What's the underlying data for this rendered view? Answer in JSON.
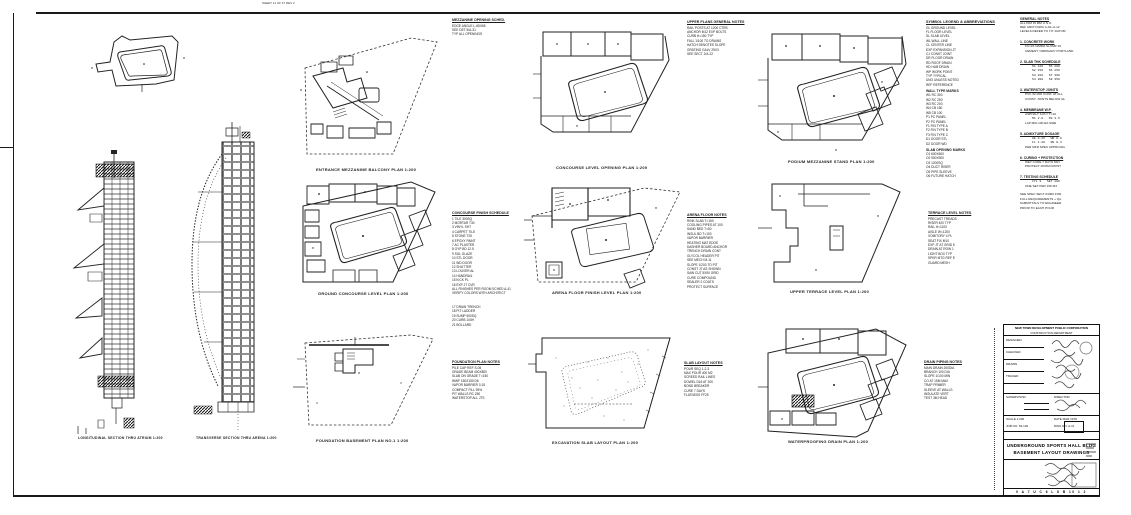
{
  "sheet": {
    "top_annotation": "SHEET 11 OF 47  REV 2",
    "ink": "#1a1a1a",
    "paper": "#ffffff"
  },
  "elevations": {
    "cap1": "LONGITUDINAL SECTION THRU ATRIUM 1:200",
    "cap2": "TRANSVERSE SECTION THRU ARENA 1:200"
  },
  "plans": {
    "r1c1": {
      "caption": "ENTRANCE MEZZANINE BALCONY PLAN 1:200"
    },
    "r1c2": {
      "caption": "CONCOURSE LEVEL OPENING PLAN 1:200"
    },
    "r1c3": {
      "caption": "PODIUM MEZZANINE STAND PLAN 1:200"
    },
    "r2c1": {
      "caption": "GROUND CONCOURSE LEVEL PLAN 1:200"
    },
    "r2c2": {
      "caption": "ARENA FLOOR FINISH LEVEL PLAN 1:200"
    },
    "r2c3": {
      "caption": "UPPER TERRACE LEVEL PLAN 1:200"
    },
    "r3c1": {
      "caption": "FOUNDATION BASEMENT PLAN NO.1 1:200"
    },
    "r3c2": {
      "caption": "EXCAVATION SLAB LAYOUT PLAN 1:200"
    },
    "r3c3": {
      "caption": "WATERPROOFING DRAIN PLAN 1:200"
    }
  },
  "notes": {
    "A": {
      "title": "MEZZANINE OPENING SCHED.",
      "lines": [
        "EDGE ANGLE L-65X65",
        "SEE DET 5/A-31",
        "TYP ALL OPENINGS"
      ]
    },
    "B": {
      "title": "UPPER PLANS GENERAL NOTES",
      "lines": [
        "RAIL POSTS AT 1200 CTRS",
        "ANCHOR M12 EXP BOLTS",
        "CURB H=150 TYP",
        "FALL 1/100 TO DRAINS",
        "HATCH DENOTES SLOPE",
        "GRATING GALV 25X3",
        "SEE SECT 2/A-22"
      ]
    },
    "C": {
      "title": "CONCOURSE FINISH SCHEDULE",
      "lines": [
        "1 TILE 300SQ",
        "2 MORTAR T30",
        "3 VINYL SHT",
        "4 CARPET TILE",
        "5 STONE T25",
        "6 EPOXY PAINT",
        "7 AC PLASTER",
        "8 GYP BD 12.5",
        "9 SGL GLAZE",
        "10 STL DOOR",
        "11 WD DOOR",
        "12 SHUTTER",
        "13 LOUVER AL",
        "14 HANDRAIL",
        "15 KICK PL",
        "16 EXP JT CVR",
        "ALL FINISHES PER ROOM SCHED A-41",
        "VERIFY COLORS WITH ARCHITECT"
      ]
    },
    "C2": {
      "lines": [
        "17 DRAIN TRENCH",
        "18 PIT LADDER",
        "19 SUMP 600SQ",
        "20 CURB 100H",
        "21 BOLLARD"
      ]
    },
    "D": {
      "title": "ARENA FLOOR NOTES",
      "lines": [
        "RINK SLAB T=150",
        "COOLING PIPES AT 100",
        "SAND BED T=50",
        "INSUL BD T=100",
        "VAPOR BARRIER",
        "HEATING MAT EDGE",
        "DASHER BOARD ANCHOR",
        "TRENCH DRAIN CONT",
        "GLYCOL HEADER PIT",
        "SEE MECH M-11",
        "SLOPE 1/200 TO PIT",
        "CONST JT AS SHOWN",
        "SAW CUT 5X50 GRID",
        "CURE COMPOUND",
        "SEALER 2 COATS",
        "PROTECT SURFACE"
      ]
    },
    "E": {
      "title": "TERRACE LEVEL NOTES",
      "lines": [
        "PRECAST TREADS",
        "RISER 400 TYP",
        "RAIL H=1100",
        "AISLE W=1200",
        "VOMITORY 4 PL",
        "SEAT FIX M10",
        "EXP JT AT GRID 5",
        "DRAIN AT ROW 1",
        "LIGHT BOX TYP",
        "SPKR MTG REF E",
        "GUARD MESH"
      ]
    },
    "F": {
      "title": "FOUNDATION PLAN NOTES",
      "lines": [
        "PILE CAP REF S-05",
        "GRADE BEAM 400X800",
        "SLAB ON GRADE T=150",
        "WWF 150X150 D6",
        "VAPOR BARRIER 0.15",
        "COMPACT FILL 95%",
        "PIT WALLS RC 250",
        "WATERSTOP ALL JTS"
      ]
    },
    "G": {
      "title": "SLAB LAYOUT NOTES",
      "lines": [
        "POUR SEQ 1-2-3",
        "MAX POUR 400 M2",
        "SCREED RAIL LINES",
        "DOWEL D16 AT 300",
        "BOND BREAKER",
        "CURE 7 DAYS",
        "FLATNESS FF25"
      ]
    },
    "H": {
      "title": "DRAIN PIPING NOTES",
      "lines": [
        "MAIN DRAIN 200DIA",
        "BRANCH 100 DIA",
        "SLOPE 1/100 MIN",
        "CO AT 15M MAX",
        "TRAP PRIMER",
        "SLEEVE AT WALLS",
        "INSULATE VERT",
        "TEST 3M HEAD"
      ]
    }
  },
  "legend": {
    "title": "SYMBOL LEGEND & ABBREVIATIONS",
    "lines1": [
      "GL GROUND LEVEL",
      "FL FLOOR LEVEL",
      "SL SLAB LEVEL",
      "WL WALL LINE",
      "CL CENTER LINE",
      "EXP EXPANSION JT",
      "CJ CONST JOINT",
      "DR FLOOR DRAIN",
      "RD ROOF DRAIN",
      "HD HUB DRAIN",
      "WP WORK POINT",
      "TYP TYPICAL",
      "UNO UNLESS NOTED",
      "REF REFERENCE"
    ],
    "sub1": "WALL TYPE MARKS",
    "lines2": [
      "W1 RC 300",
      "W2 RC 250",
      "W3 RC 200",
      "W4 CB 150",
      "W5 CB 100",
      "P1 PC PANEL",
      "P2 PC PANEL",
      "F1 FIN TYPE A",
      "F2 FIN TYPE B",
      "F3 FIN TYPE C",
      "D1 DOOR STL",
      "D2 DOOR WD"
    ],
    "sub2": "SLAB OPENING MARKS",
    "lines3": [
      "O1 600X600",
      "O2 900X900",
      "O3 1200SQ",
      "O4 DUCT RISER",
      "O5 PIPE SLEEVE",
      "O6 FUTURE HATCH"
    ]
  },
  "rightcol": {
    "blocks": [
      {
        "k": "h",
        "t": "GENERAL NOTES"
      },
      {
        "k": "l",
        "t": "ALL DIM IN MM U.N.O."
      },
      {
        "k": "l",
        "t": "REF ARCH DWG A-01~A-12"
      },
      {
        "k": "l",
        "t": "LEVELS REFER TO T.P. DATUM"
      },
      {
        "k": "g",
        "t": ""
      },
      {
        "k": "h",
        "t": "1. CONCRETE WORK"
      },
      {
        "k": "i",
        "t": "FC=24 N/MM2 SLUMP 15"
      },
      {
        "k": "i",
        "t": "CEMENT: ORDINARY PORTLAND"
      },
      {
        "k": "g",
        "t": ""
      },
      {
        "k": "h",
        "t": "2. SLAB THK SCHEDULE"
      },
      {
        "k": "t",
        "t": "S1 120   S5 200"
      },
      {
        "k": "t",
        "t": "S2 150   S6 250"
      },
      {
        "k": "t",
        "t": "S3 180   S7 300"
      },
      {
        "k": "t",
        "t": "S4 200   S8 350"
      },
      {
        "k": "g",
        "t": ""
      },
      {
        "k": "h",
        "t": "3. WATERSTOP JOINTS"
      },
      {
        "k": "i",
        "t": "PVC W=200 CONT. AT ALL"
      },
      {
        "k": "i",
        "t": "CONST. JOINTS BELOW GL"
      },
      {
        "k": "g",
        "t": ""
      },
      {
        "k": "h",
        "t": "4. MEMBRANE W.P."
      },
      {
        "k": "i",
        "t": "ASPHALT 3-PLY T=10"
      },
      {
        "k": "t",
        "t": "M1 2.0   M2 3.5"
      },
      {
        "k": "i",
        "t": "LAP MIN 100 EA SIDE"
      },
      {
        "k": "g",
        "t": ""
      },
      {
        "k": "h",
        "t": "5. ADMIXTURE DOSAGE"
      },
      {
        "k": "t",
        "t": "AE 0.25   WR 0.8"
      },
      {
        "k": "t",
        "t": "FL 1.20   RE 0.4"
      },
      {
        "k": "i",
        "t": "PER MFR SPEC APPROVAL"
      },
      {
        "k": "g",
        "t": ""
      },
      {
        "k": "h",
        "t": "6. CURING + PROTECTION"
      },
      {
        "k": "i",
        "t": "WET CURE 7 DAYS MIN"
      },
      {
        "k": "i",
        "t": "PROTECT FROM FROST"
      },
      {
        "k": "g",
        "t": ""
      },
      {
        "k": "h",
        "t": "7. TESTING SCHEDULE"
      },
      {
        "k": "t",
        "t": "CYL 3   SET 28D"
      },
      {
        "k": "i",
        "t": "ONE SET PER 150 M3"
      },
      {
        "k": "g",
        "t": ""
      },
      {
        "k": "l",
        "t": "SEE SPEC SECT 03300 FOR"
      },
      {
        "k": "l",
        "t": "FULL REQUIREMENTS + QA"
      },
      {
        "k": "l",
        "t": "SUBMITTALS TO ENGINEER"
      },
      {
        "k": "l",
        "t": "PRIOR TO EACH POUR"
      }
    ]
  },
  "titleblock": {
    "org1": "NEW TOWN DEVELOPMENT PUBLIC CORPORATION",
    "org2": "CONSTRUCTION DEPARTMENT",
    "row_designed": "DESIGNED",
    "row_checked": "CHECKED",
    "row_drawn": "DRAWN",
    "row_traced": "TRACED",
    "row_supervisor": "SUPERVISOR",
    "row_director": "DIRECTOR",
    "scale": "SCALE 1:200",
    "date": "DATE MAR.1978",
    "job": "JOB NO. 53-102",
    "dwg": "DWG NO. A-11",
    "title1": "UNDERGROUND SPORTS HALL BLDG",
    "title2": "BASEMENT LAYOUT DRAWINGS",
    "bottom_strip": "0 A 7 U C 6 L 8 B 10 1 2"
  }
}
